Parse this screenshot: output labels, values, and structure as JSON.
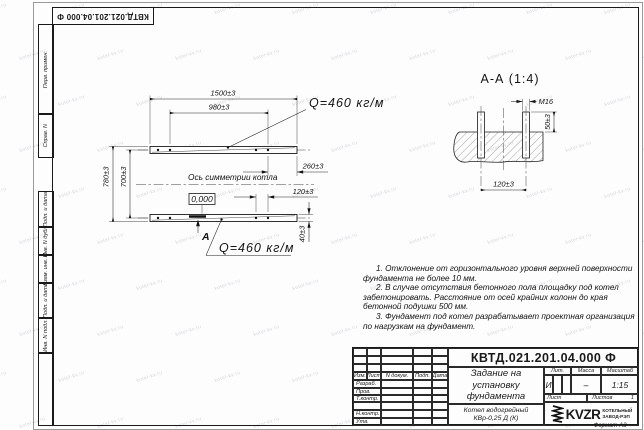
{
  "sheet": {
    "designation_corner": "КВТД.021.201.04.000 Ф",
    "format_label": "Формат А3",
    "watermark_text": "kotel-kv.ru"
  },
  "margin_stamps": {
    "items": [
      "Перв. примен.",
      "Справ. N",
      "Подп. и дата",
      "Инв. N дубл.",
      "Взам. инв. N",
      "Подп. и дата",
      "Инв. N подл."
    ]
  },
  "main_view": {
    "dim_1500": "1500±3",
    "dim_980": "980±3",
    "dim_780": "780±3",
    "dim_700": "700±3",
    "dim_260": "260±3",
    "dim_120": "120±3",
    "dim_40": "40±3",
    "load_top": "Q=460 кг/м",
    "load_bottom": "Q=460 кг/м",
    "axis_label": "Ось симметрии котла",
    "level_mark": "0,000",
    "section_letter": "А"
  },
  "section_view": {
    "title": "А-А (1:4)",
    "thread_label": "М16",
    "dim_50": "50±3",
    "dim_120": "120±3"
  },
  "notes": {
    "line1": "1. Отклонение от горизонтального уровня верхней поверхности фундамента не более 10 мм.",
    "line2": "2. В случае отсутствия бетонного пола площадку под котел забетонировать. Расстояние от осей крайних колонн до края бетонной подушки 500 мм.",
    "line3": "3. Фундамент под котел разрабатывает проектная организация по нагрузкам на фундамент."
  },
  "title_block": {
    "designation": "КВТД.021.201.04.000 Ф",
    "doc_name": "Задание на установку фундамента",
    "product": "Котел водогрейный КВр-0,25 Д (К)",
    "col_izm": "Изм.",
    "col_list": "Лист",
    "col_ndoc": "N докум.",
    "col_podp": "Подп.",
    "col_data": "Дата",
    "row_razrab": "Разраб.",
    "row_prov": "Пров.",
    "row_tkontr": "Т.контр.",
    "row_nkontr": "Н.контр.",
    "row_utv": "Утв.",
    "lit_label": "Лит.",
    "lit_value": "И",
    "mass_label": "Масса",
    "mass_value": "–",
    "scale_label": "Масштаб",
    "scale_value": "1:15",
    "sheet_label": "Лист",
    "sheets_label": "Листов",
    "sheets_value": "1",
    "logo_text": "KVZR",
    "logo_line1": "КОТЕЛЬНЫЙ",
    "logo_line2": "ЗАВОД-РЭП"
  }
}
